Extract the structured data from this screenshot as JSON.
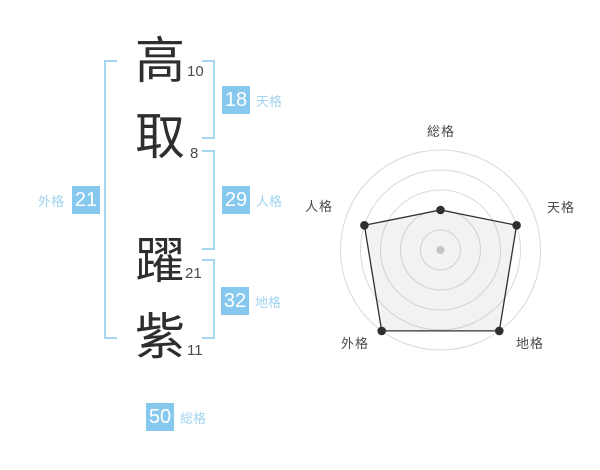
{
  "colors": {
    "badge-bg": "#87c9ee",
    "badge-text": "#ffffff",
    "label-blue": "#a0d4f1",
    "bracket": "#a6d8f3",
    "kanji": "#2e2e2e",
    "stroke-num": "#4b4b4b",
    "ring": "#d9d9d9",
    "polygon-fill": "rgba(150,150,150,0.12)",
    "polygon-stroke": "#2f2f2f",
    "vertex-dot": "#2f2f2f",
    "center-dot": "#c4c4c4",
    "axis-label": "#4a4a4a"
  },
  "name_block": {
    "characters": [
      {
        "char": "高",
        "strokes": "10"
      },
      {
        "char": "取",
        "strokes": "8"
      },
      {
        "char": "躍",
        "strokes": "21"
      },
      {
        "char": "紫",
        "strokes": "11"
      }
    ]
  },
  "scores": {
    "tenkaku": {
      "num": "18",
      "label": "天格"
    },
    "jinkaku": {
      "num": "29",
      "label": "人格"
    },
    "chikaku": {
      "num": "32",
      "label": "地格"
    },
    "gaikaku": {
      "num": "21",
      "label": "外格"
    },
    "soukaku": {
      "num": "50",
      "label": "総格"
    }
  },
  "chart_data": {
    "type": "radar",
    "categories": [
      "総格",
      "天格",
      "地格",
      "外格",
      "人格"
    ],
    "values": [
      2,
      4,
      5,
      5,
      4
    ],
    "max": 5,
    "rings": 5,
    "grid": "concentric-circles-no-spokes",
    "legend": "none",
    "start_angle_deg": -90,
    "direction": "clockwise"
  }
}
